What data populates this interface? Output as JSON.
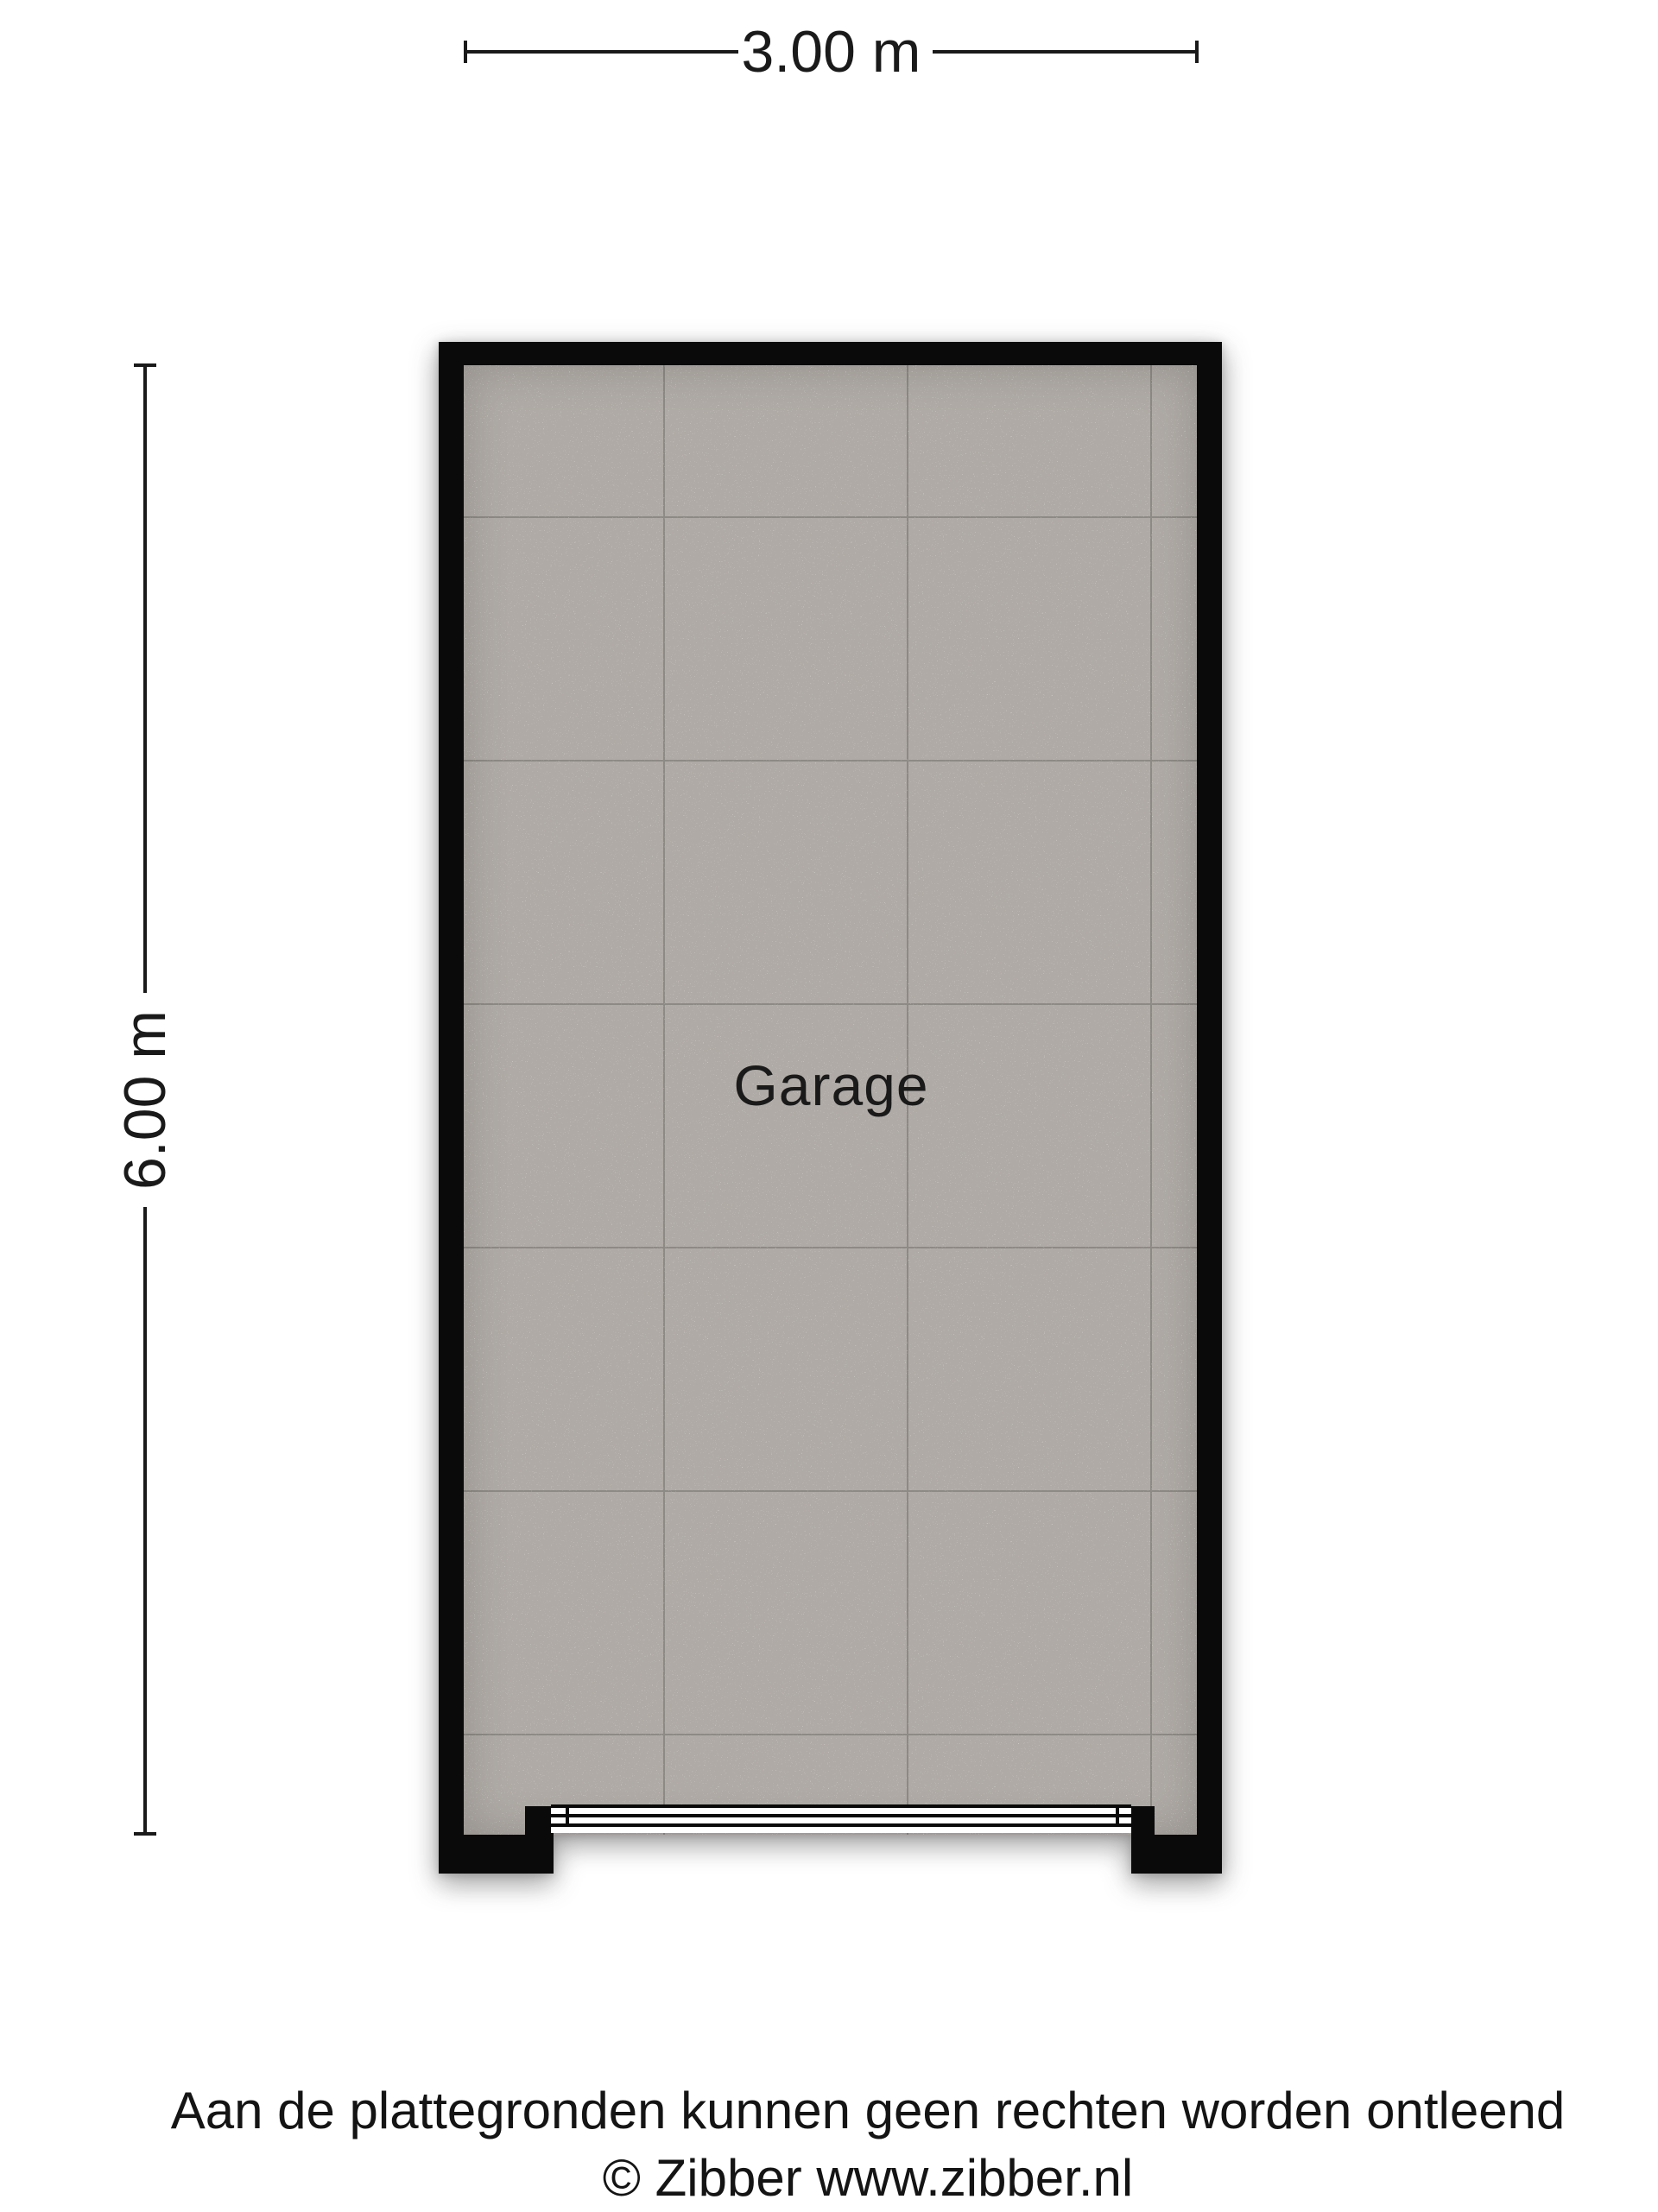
{
  "floorplan": {
    "room": {
      "label": "Garage"
    },
    "dimensions": {
      "width_label": "3.00 m",
      "height_label": "6.00 m"
    },
    "colors": {
      "wall": "#0a0a0a",
      "floor": "#afaaa5",
      "grout": "#8d8984",
      "door": "#ffffff",
      "ink": "#1a1a1a"
    }
  },
  "footer": {
    "disclaimer": "Aan de plattegronden kunnen geen rechten worden ontleend",
    "copyright": "© Zibber www.zibber.nl"
  }
}
